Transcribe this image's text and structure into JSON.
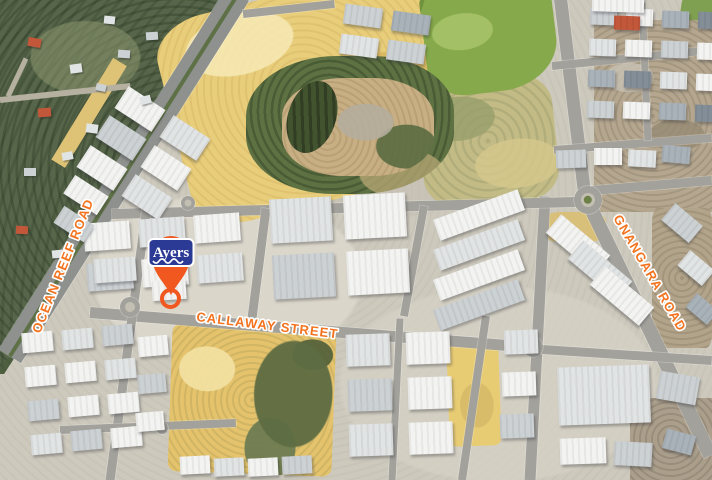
{
  "map": {
    "canvas": {
      "width": 712,
      "height": 480
    },
    "labels": {
      "ocean_reef": "OCEAN REEF ROAD",
      "callaway": "CALLAWAY STREET",
      "gnangara": "GNANGARA ROAD"
    },
    "marker": {
      "brand": "Ayers"
    },
    "colors": {
      "label_orange": "#f4731f",
      "marker_orange": "#f0581f",
      "brand_blue": "#2b3a94",
      "shades": {
        "w": "#f3f4f2",
        "l": "#e1e4e4",
        "m": "#ccd1d4",
        "d": "#a9b2b9",
        "s": "#848e98",
        "b": "#8fa3b5",
        "t": "#b59b75",
        "r": "#c2573a",
        "g": "#6f7d8a"
      }
    },
    "roads": [
      [
        120,
        62,
        58,
        164,
        16,
        "sandstrip"
      ],
      [
        0,
        100,
        130,
        86,
        6,
        "track"
      ],
      [
        26,
        58,
        8,
        96,
        5,
        "track"
      ],
      [
        238,
        -6,
        10,
        356,
        26,
        "main"
      ],
      [
        238,
        -6,
        10,
        356,
        4,
        "median"
      ],
      [
        560,
        -6,
        585,
        196,
        13,
        "road"
      ],
      [
        585,
        196,
        710,
        455,
        14,
        "road"
      ],
      [
        592,
        190,
        712,
        180,
        9,
        "road"
      ],
      [
        545,
        196,
        530,
        480,
        11,
        "road"
      ],
      [
        90,
        312,
        533,
        347,
        11,
        "road"
      ],
      [
        542,
        349,
        712,
        360,
        9,
        "road"
      ],
      [
        112,
        214,
        576,
        202,
        10,
        "road"
      ],
      [
        148,
        198,
        110,
        480,
        9,
        "road"
      ],
      [
        266,
        208,
        252,
        318,
        9,
        "road"
      ],
      [
        424,
        206,
        404,
        316,
        8,
        "road"
      ],
      [
        486,
        316,
        462,
        480,
        8,
        "road"
      ],
      [
        400,
        318,
        392,
        480,
        7,
        "road"
      ],
      [
        60,
        430,
        236,
        423,
        8,
        "road"
      ],
      [
        243,
        14,
        334,
        4,
        8,
        "road"
      ],
      [
        552,
        66,
        712,
        50,
        8,
        "road"
      ],
      [
        554,
        150,
        712,
        138,
        8,
        "road"
      ],
      [
        642,
        2,
        648,
        140,
        7,
        "road"
      ]
    ],
    "roundabouts": [
      [
        588,
        200,
        14
      ],
      [
        533,
        347,
        10
      ],
      [
        130,
        307,
        10
      ],
      [
        188,
        203,
        7
      ],
      [
        162,
        428,
        6
      ]
    ],
    "clusters": [
      [
        118,
        96,
        2,
        3,
        44,
        26,
        10,
        9,
        33,
        33,
        "wlmw"
      ],
      [
        84,
        222,
        3,
        2,
        46,
        28,
        9,
        12,
        -4,
        -4,
        "wlwm"
      ],
      [
        270,
        198,
        2,
        2,
        62,
        44,
        12,
        12,
        -3,
        -3,
        "lwmw"
      ],
      [
        434,
        204,
        1,
        4,
        90,
        22,
        0,
        8,
        -20,
        0,
        "wlwm"
      ],
      [
        590,
        8,
        4,
        4,
        27,
        17,
        9,
        14,
        2,
        2,
        "mwdslw"
      ],
      [
        22,
        332,
        3,
        4,
        31,
        20,
        9,
        14,
        -5,
        -5,
        "wlmw"
      ],
      [
        346,
        334,
        2,
        3,
        44,
        32,
        16,
        13,
        -2,
        -2,
        "lwmw"
      ],
      [
        344,
        6,
        2,
        2,
        38,
        20,
        10,
        10,
        8,
        8,
        "mdl"
      ]
    ],
    "buildings": [
      [
        152,
        280,
        34,
        20,
        -4,
        "w"
      ],
      [
        94,
        258,
        42,
        24,
        -4,
        "l"
      ],
      [
        66,
        184,
        40,
        22,
        33,
        "w"
      ],
      [
        56,
        214,
        36,
        20,
        33,
        "m"
      ],
      [
        546,
        232,
        64,
        24,
        40,
        "w"
      ],
      [
        568,
        258,
        64,
        24,
        40,
        "l"
      ],
      [
        590,
        284,
        64,
        24,
        40,
        "w"
      ],
      [
        664,
        212,
        36,
        22,
        40,
        "m"
      ],
      [
        680,
        258,
        32,
        20,
        40,
        "l"
      ],
      [
        688,
        300,
        28,
        18,
        40,
        "d"
      ],
      [
        558,
        366,
        92,
        58,
        -2,
        "l"
      ],
      [
        658,
        374,
        40,
        28,
        10,
        "m"
      ],
      [
        560,
        438,
        46,
        26,
        -2,
        "w"
      ],
      [
        614,
        442,
        38,
        24,
        3,
        "m"
      ],
      [
        664,
        432,
        30,
        20,
        15,
        "d"
      ],
      [
        138,
        336,
        30,
        20,
        -5,
        "w"
      ],
      [
        138,
        374,
        28,
        19,
        -5,
        "m"
      ],
      [
        136,
        412,
        28,
        19,
        -5,
        "w"
      ],
      [
        504,
        330,
        34,
        24,
        -2,
        "l"
      ],
      [
        502,
        372,
        34,
        24,
        -2,
        "w"
      ],
      [
        500,
        414,
        34,
        24,
        -2,
        "m"
      ],
      [
        180,
        456,
        30,
        18,
        -3,
        "w"
      ],
      [
        214,
        458,
        30,
        18,
        -3,
        "l"
      ],
      [
        248,
        458,
        30,
        18,
        -3,
        "w"
      ],
      [
        282,
        456,
        30,
        18,
        -3,
        "m"
      ],
      [
        556,
        150,
        30,
        18,
        -2,
        "m"
      ],
      [
        594,
        148,
        28,
        17,
        0,
        "w"
      ],
      [
        628,
        150,
        28,
        17,
        3,
        "l"
      ],
      [
        662,
        146,
        28,
        17,
        5,
        "d"
      ],
      [
        592,
        -4,
        52,
        16,
        2,
        "w"
      ],
      [
        614,
        16,
        26,
        14,
        2,
        "r"
      ]
    ],
    "houses": [
      [
        28,
        38,
        13,
        9,
        10,
        "r"
      ],
      [
        70,
        64,
        12,
        9,
        -8,
        "l"
      ],
      [
        118,
        50,
        12,
        8,
        4,
        "m"
      ],
      [
        38,
        108,
        13,
        9,
        -5,
        "r"
      ],
      [
        86,
        124,
        12,
        9,
        8,
        "l"
      ],
      [
        24,
        168,
        12,
        8,
        0,
        "m"
      ],
      [
        62,
        152,
        11,
        8,
        -10,
        "l"
      ],
      [
        104,
        16,
        11,
        8,
        6,
        "l"
      ],
      [
        146,
        32,
        12,
        8,
        -4,
        "m"
      ],
      [
        16,
        226,
        12,
        8,
        4,
        "r"
      ],
      [
        52,
        250,
        11,
        8,
        -6,
        "l"
      ],
      [
        96,
        84,
        10,
        7,
        12,
        "m"
      ],
      [
        140,
        96,
        11,
        8,
        -15,
        "l"
      ]
    ]
  }
}
